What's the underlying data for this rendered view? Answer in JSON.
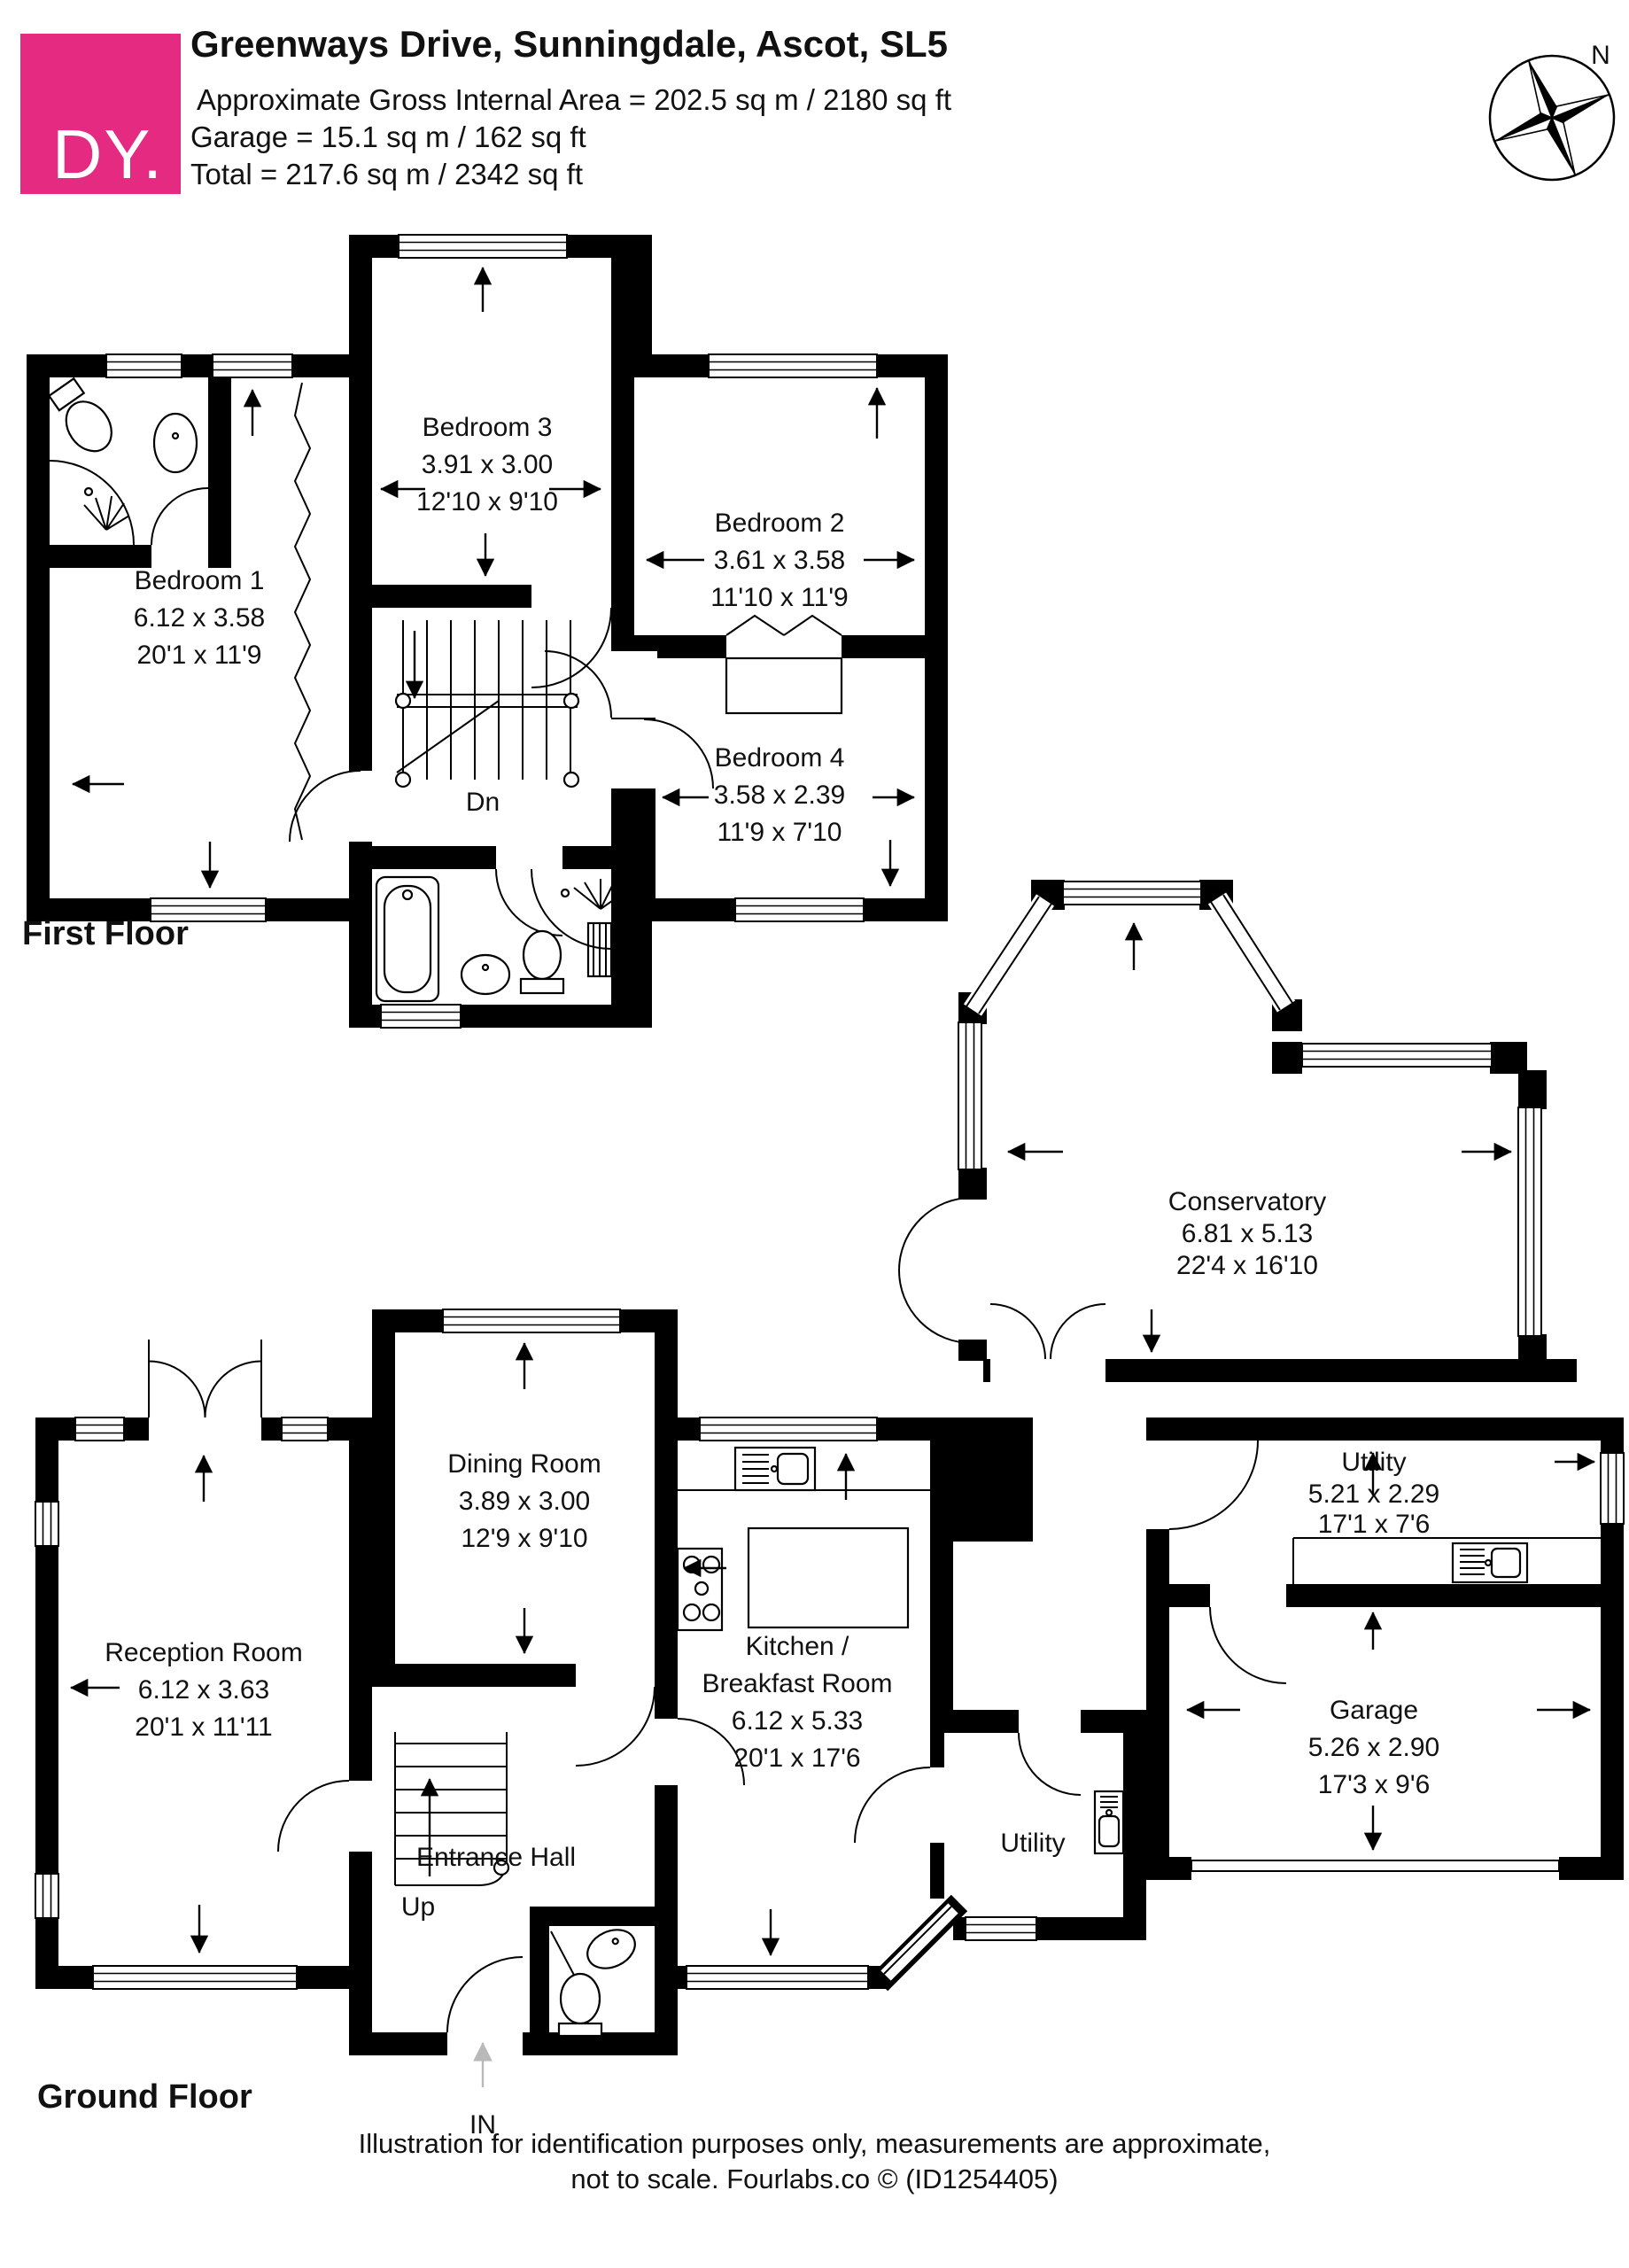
{
  "header": {
    "logo": "DY.",
    "title": "Greenways Drive, Sunningdale, Ascot, SL5",
    "area_line": "Approximate Gross Internal Area = 202.5 sq m / 2180 sq ft",
    "garage_line": "Garage = 15.1 sq m / 162 sq ft",
    "total_line": "Total = 217.6 sq m / 2342 sq ft"
  },
  "compass": {
    "north": "N"
  },
  "floors": {
    "first": {
      "label": "First Floor",
      "stair": "Dn",
      "rooms": {
        "bedroom1": {
          "name": "Bedroom 1",
          "metric": "6.12 x 3.58",
          "imperial": "20'1 x 11'9"
        },
        "bedroom2": {
          "name": "Bedroom 2",
          "metric": "3.61 x 3.58",
          "imperial": "11'10 x 11'9"
        },
        "bedroom3": {
          "name": "Bedroom 3",
          "metric": "3.91 x 3.00",
          "imperial": "12'10 x 9'10"
        },
        "bedroom4": {
          "name": "Bedroom 4",
          "metric": "3.58 x 2.39",
          "imperial": "11'9 x 7'10"
        }
      }
    },
    "ground": {
      "label": "Ground Floor",
      "stair": "Up",
      "entrance": "Entrance Hall",
      "in_label": "IN",
      "rooms": {
        "reception": {
          "name": "Reception Room",
          "metric": "6.12 x 3.63",
          "imperial": "20'1 x 11'11"
        },
        "dining": {
          "name": "Dining Room",
          "metric": "3.89 x 3.00",
          "imperial": "12'9 x 9'10"
        },
        "kitchen": {
          "name": "Kitchen /",
          "name2": "Breakfast Room",
          "metric": "6.12 x 5.33",
          "imperial": "20'1 x 17'6"
        },
        "conservatory": {
          "name": "Conservatory",
          "metric": "6.81 x 5.13",
          "imperial": "22'4 x 16'10"
        },
        "utility": {
          "name": "Utility",
          "metric": "5.21 x 2.29",
          "imperial": "17'1 x 7'6"
        },
        "utility_small": {
          "name": "Utility"
        },
        "garage": {
          "name": "Garage",
          "metric": "5.26 x 2.90",
          "imperial": "17'3 x 9'6"
        }
      }
    }
  },
  "footer": {
    "line1": "Illustration for identification purposes only, measurements are approximate,",
    "line2": "not to scale. Fourlabs.co © (ID1254405)"
  },
  "colors": {
    "brand": "#E52A82"
  }
}
